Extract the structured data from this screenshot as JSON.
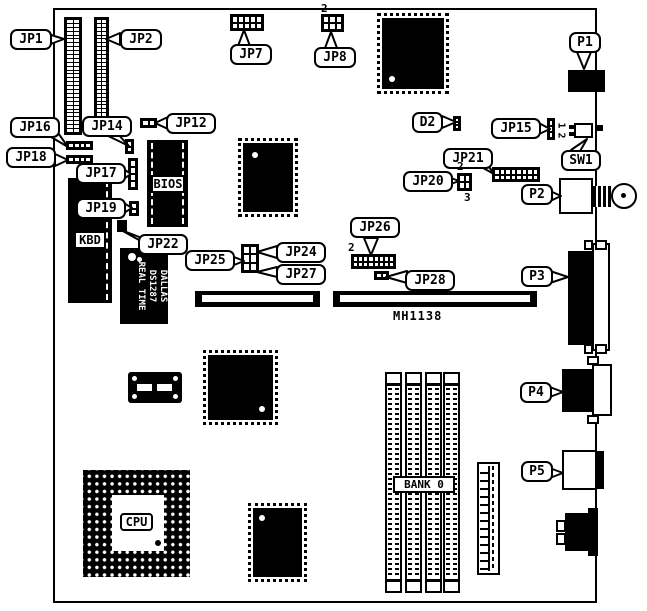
{
  "board_code": "MH1138",
  "callouts": {
    "jp1": "JP1",
    "jp2": "JP2",
    "jp7": "JP7",
    "jp8": "JP8",
    "jp12": "JP12",
    "jp14": "JP14",
    "jp15": "JP15",
    "jp16": "JP16",
    "jp17": "JP17",
    "jp18": "JP18",
    "jp19": "JP19",
    "jp20": "JP20",
    "jp21": "JP21",
    "jp22": "JP22",
    "jp24": "JP24",
    "jp25": "JP25",
    "jp26": "JP26",
    "jp27": "JP27",
    "jp28": "JP28",
    "p1": "P1",
    "p2": "P2",
    "p3": "P3",
    "p4": "P4",
    "p5": "P5",
    "d2": "D2",
    "sw1": "SW1"
  },
  "chip_labels": {
    "bios": "BIOS",
    "kbd": "KBD",
    "cpu": "CPU",
    "bank": "BANK 0"
  },
  "rtc_chip": {
    "line1": "DALLAS",
    "line2": "DS1287",
    "line3": "REAL TIME"
  },
  "pin_numbers": {
    "jp8": "2",
    "jp20_top": "2",
    "jp20_bottom": "3",
    "jp26": "2",
    "sw1_top": "1",
    "sw1_bottom": "2"
  }
}
